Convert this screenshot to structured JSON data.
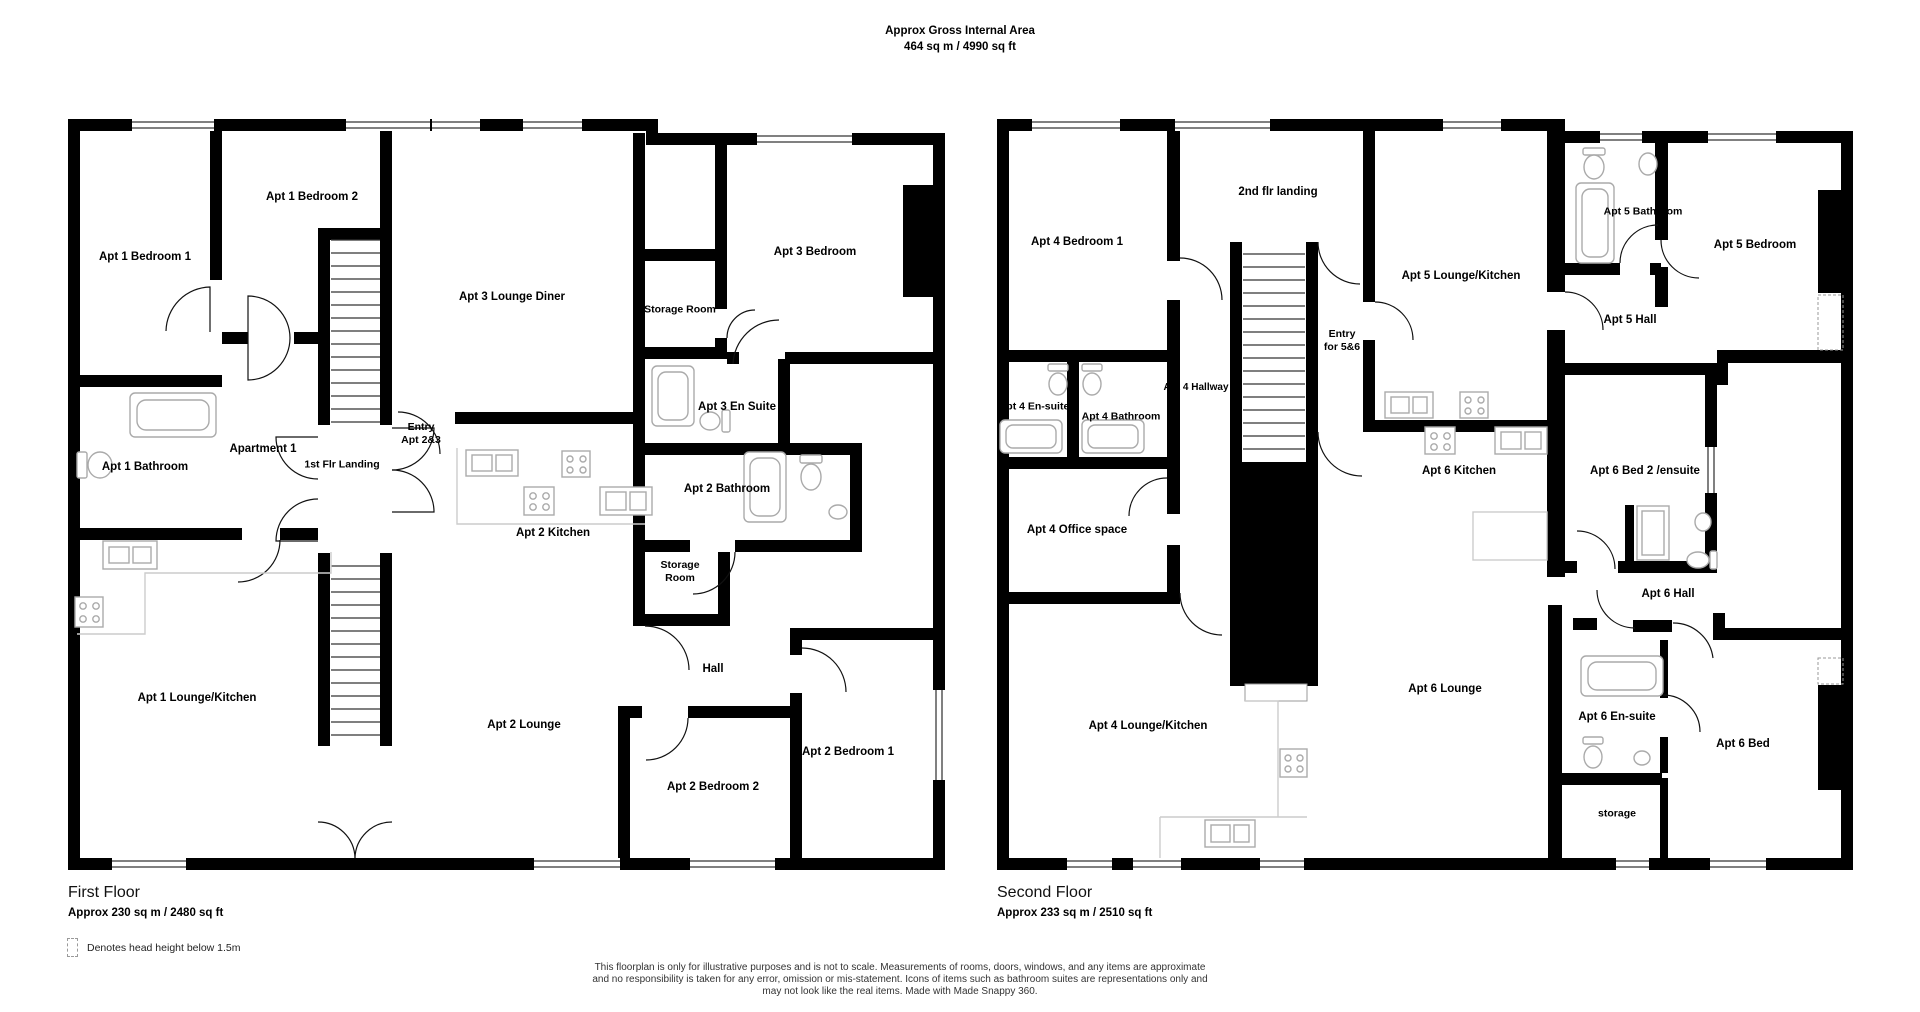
{
  "header": {
    "title": "Approx Gross Internal Area",
    "subtitle": "464 sq m / 4990 sq ft"
  },
  "floors": [
    {
      "name": "First Floor",
      "area": "Approx 230 sq m / 2480 sq ft",
      "rooms": [
        {
          "label": "Apt 1 Bedroom 1"
        },
        {
          "label": "Apt 1 Bedroom 2"
        },
        {
          "label": "Apt 3 Lounge Diner"
        },
        {
          "label": "Apt 3 Bedroom"
        },
        {
          "label": "Storage Room"
        },
        {
          "label": "Apt 3 En Suite"
        },
        {
          "label": "Apt 1 Bathroom"
        },
        {
          "label": "Apartment 1"
        },
        {
          "label": "Entry\nApt 2&3"
        },
        {
          "label": "1st Flr Landing"
        },
        {
          "label": "Apt 2 Bathroom"
        },
        {
          "label": "Apt 2 Kitchen"
        },
        {
          "label": "Storage\nRoom"
        },
        {
          "label": "Hall"
        },
        {
          "label": "Apt 1 Lounge/Kitchen"
        },
        {
          "label": "Apt 2 Lounge"
        },
        {
          "label": "Apt 2 Bedroom 1"
        },
        {
          "label": "Apt 2 Bedroom 2"
        }
      ]
    },
    {
      "name": "Second Floor",
      "area": "Approx 233 sq m / 2510 sq ft",
      "rooms": [
        {
          "label": "Apt 4 Bedroom 1"
        },
        {
          "label": "2nd flr landing"
        },
        {
          "label": "Apt 5 Lounge/Kitchen"
        },
        {
          "label": "Apt 5 Bathroom"
        },
        {
          "label": "Apt 5 Bedroom"
        },
        {
          "label": "Apt 5 Hall"
        },
        {
          "label": "Entry\nfor 5&6"
        },
        {
          "label": "Apt 4 En-suite"
        },
        {
          "label": "Apt 4 Bathroom"
        },
        {
          "label": "Apt 4 Hallway"
        },
        {
          "label": "Apt 6 Kitchen"
        },
        {
          "label": "Apt 6 Bed 2 /ensuite"
        },
        {
          "label": "Apt 4 Office space"
        },
        {
          "label": "Apt 6 Hall"
        },
        {
          "label": "Apt 6 Lounge"
        },
        {
          "label": "Apt 6 En-suite"
        },
        {
          "label": "Apt 6 Bed"
        },
        {
          "label": "Apt 4 Lounge/Kitchen"
        },
        {
          "label": "storage"
        }
      ]
    }
  ],
  "legend": {
    "text": "Denotes head height below 1.5m"
  },
  "disclaimer": {
    "line1": "This floorplan is only for illustrative purposes and is not to scale. Measurements of rooms, doors, windows, and any items are approximate",
    "line2": "and no responsibility is taken for any error, omission or mis-statement. Icons of items such as bathroom suites are representations only and",
    "line3": "may not look like the real items. Made with Made Snappy 360."
  },
  "colors": {
    "wall": "#000000",
    "background": "#ffffff",
    "fixture": "#aaaaaa",
    "counter": "#cccccc",
    "dashed": "#999999"
  }
}
